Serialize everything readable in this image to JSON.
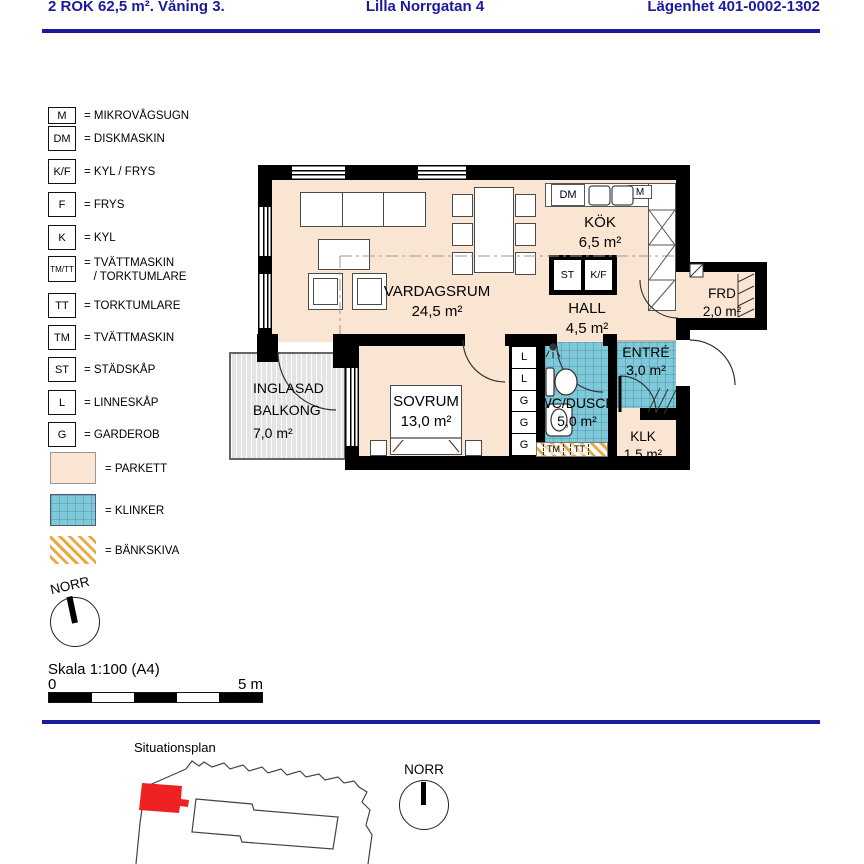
{
  "header": {
    "left": "2 ROK 62,5 m². Våning 3.",
    "center": "Lilla Norrgatan 4",
    "right": "Lägenhet 401-0002-1302"
  },
  "legend": {
    "items": [
      {
        "symbol": "M",
        "label": "= MIKROVÅGSUGN"
      },
      {
        "symbol": "DM",
        "label": "= DISKMASKIN"
      },
      {
        "symbol": "K/F",
        "label": "= KYL / FRYS"
      },
      {
        "symbol": "F",
        "label": "= FRYS"
      },
      {
        "symbol": "K",
        "label": "= KYL"
      },
      {
        "symbol": "TM/TT",
        "label": "= TVÄTTMASKIN",
        "label2": "   / TORKTUMLARE"
      },
      {
        "symbol": "TT",
        "label": "= TORKTUMLARE"
      },
      {
        "symbol": "TM",
        "label": "= TVÄTTMASKIN"
      },
      {
        "symbol": "ST",
        "label": "= STÄDSKÅP"
      },
      {
        "symbol": "L",
        "label": "= LINNESKÅP"
      },
      {
        "symbol": "G",
        "label": "= GARDEROB"
      }
    ],
    "swatches": [
      {
        "type": "parkett",
        "label": "= PARKETT"
      },
      {
        "type": "klinker",
        "label": "= KLINKER"
      },
      {
        "type": "bankskiva",
        "label": "= BÄNKSKIVA"
      }
    ]
  },
  "plan": {
    "rooms": {
      "vardagsrum": {
        "name": "VARDAGSRUM",
        "area": "24,5 m²"
      },
      "kok": {
        "name": "KÖK",
        "area": "6,5 m²"
      },
      "hall": {
        "name": "HALL",
        "area": "4,5 m²"
      },
      "frd": {
        "name": "FRD",
        "area": "2,0 m²"
      },
      "entre": {
        "name": "ENTRÉ",
        "area": "3,0 m²"
      },
      "wc": {
        "name": "WC/DUSCH",
        "area": "5,0 m²"
      },
      "klk": {
        "name": "KLK",
        "area": "1,5 m²"
      },
      "sovrum": {
        "name": "SOVRUM",
        "area": "13,0 m²"
      },
      "balkong": {
        "line1": "INGLASAD",
        "line2": "BALKONG",
        "area": "7,0 m²"
      }
    },
    "closets": [
      "L",
      "L",
      "G",
      "G",
      "G"
    ],
    "appliances": {
      "dm": "DM",
      "m": "M",
      "st": "ST",
      "kf": "K/F",
      "tm": "TM",
      "tt": "TT"
    }
  },
  "compass": {
    "label": "NORR"
  },
  "scale": {
    "text": "Skala 1:100 (A4)",
    "zero": "0",
    "end": "5 m"
  },
  "siteplan": {
    "title": "Situationsplan"
  },
  "colors": {
    "navy": "#1a1a9c",
    "parkett": "#fae5d2",
    "klinker": "#7ec9da",
    "bankskiva": "#eba93f",
    "marker": "#ee2222",
    "wall": "#000000"
  }
}
